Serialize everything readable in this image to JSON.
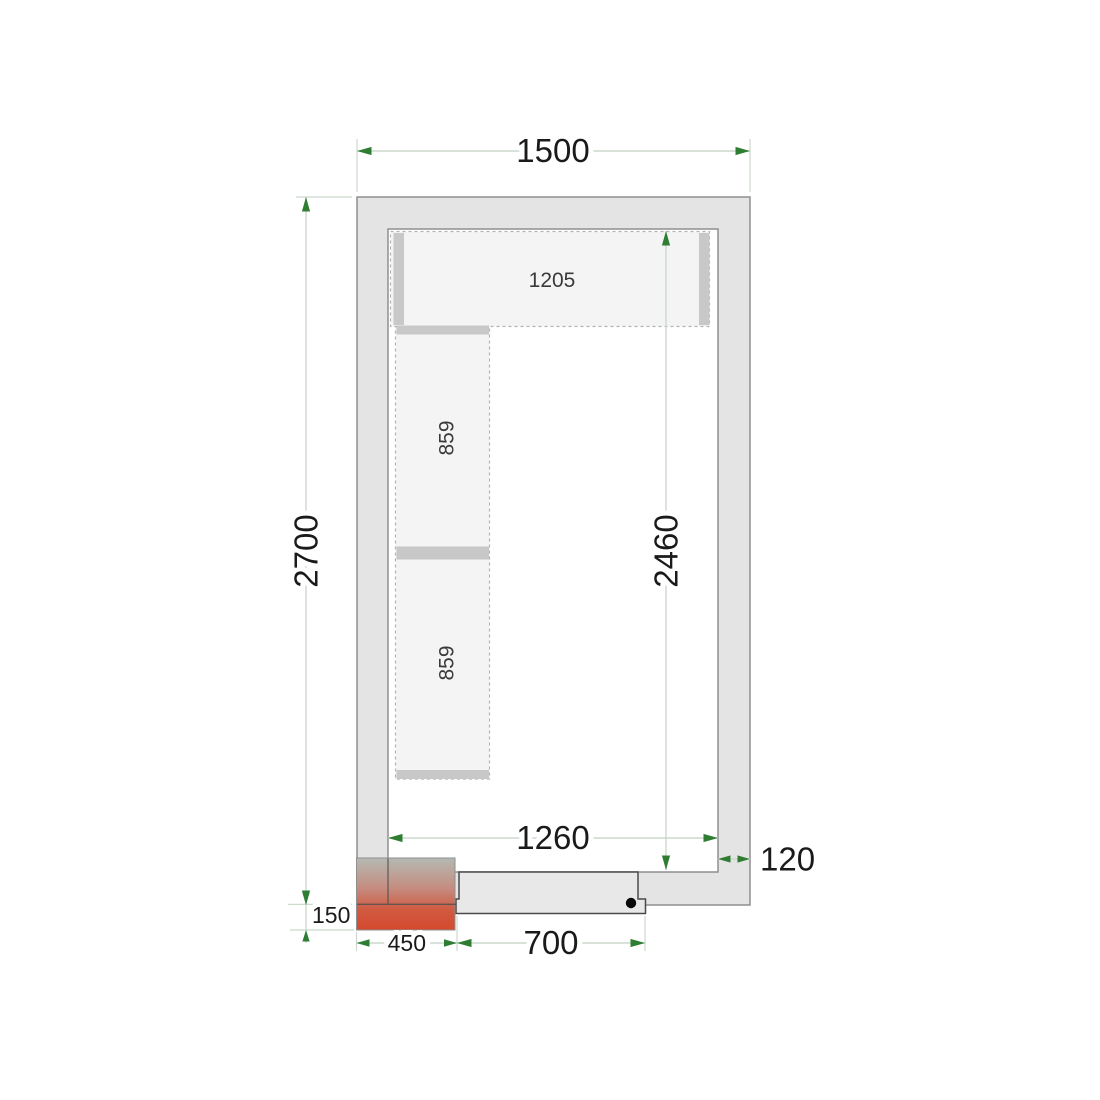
{
  "plan": {
    "description": "Cold room floor plan, top view",
    "dimensions": {
      "outer_width": "1500",
      "outer_depth": "2700",
      "inner_depth": "2460",
      "inner_width": "1260",
      "wall_thickness": "120",
      "unit_overhang": "150",
      "unit_width": "450",
      "door_width": "700"
    },
    "shelving": {
      "top_shelf_length": "1205",
      "left_shelf_upper_length": "859",
      "left_shelf_lower_length": "859"
    }
  },
  "colors": {
    "background": "#ffffff",
    "wall_fill": "#e4e4e4",
    "wall_stroke": "#8f8f8f",
    "wall_joint_line": "#4d4d4d",
    "shelf_fill": "#f4f4f4",
    "shelf_dash": "#b3b3b3",
    "shelf_bar": "#c8c8c8",
    "shelf_label": "#3a3a3a",
    "door_fill": "#e8e8e8",
    "door_stroke": "#4a4a4a",
    "door_handle": "#0a0a0a",
    "dimension_arrow": "#2e7d32",
    "dimension_line": "#ccd9cc",
    "dimension_text": "#1a1a1a",
    "unit_gradient_top": "#b4bab2",
    "unit_gradient_mid": "#c58c80",
    "unit_gradient_low": "#d05a40",
    "unit_gradient_bottom": "#d4492d"
  }
}
